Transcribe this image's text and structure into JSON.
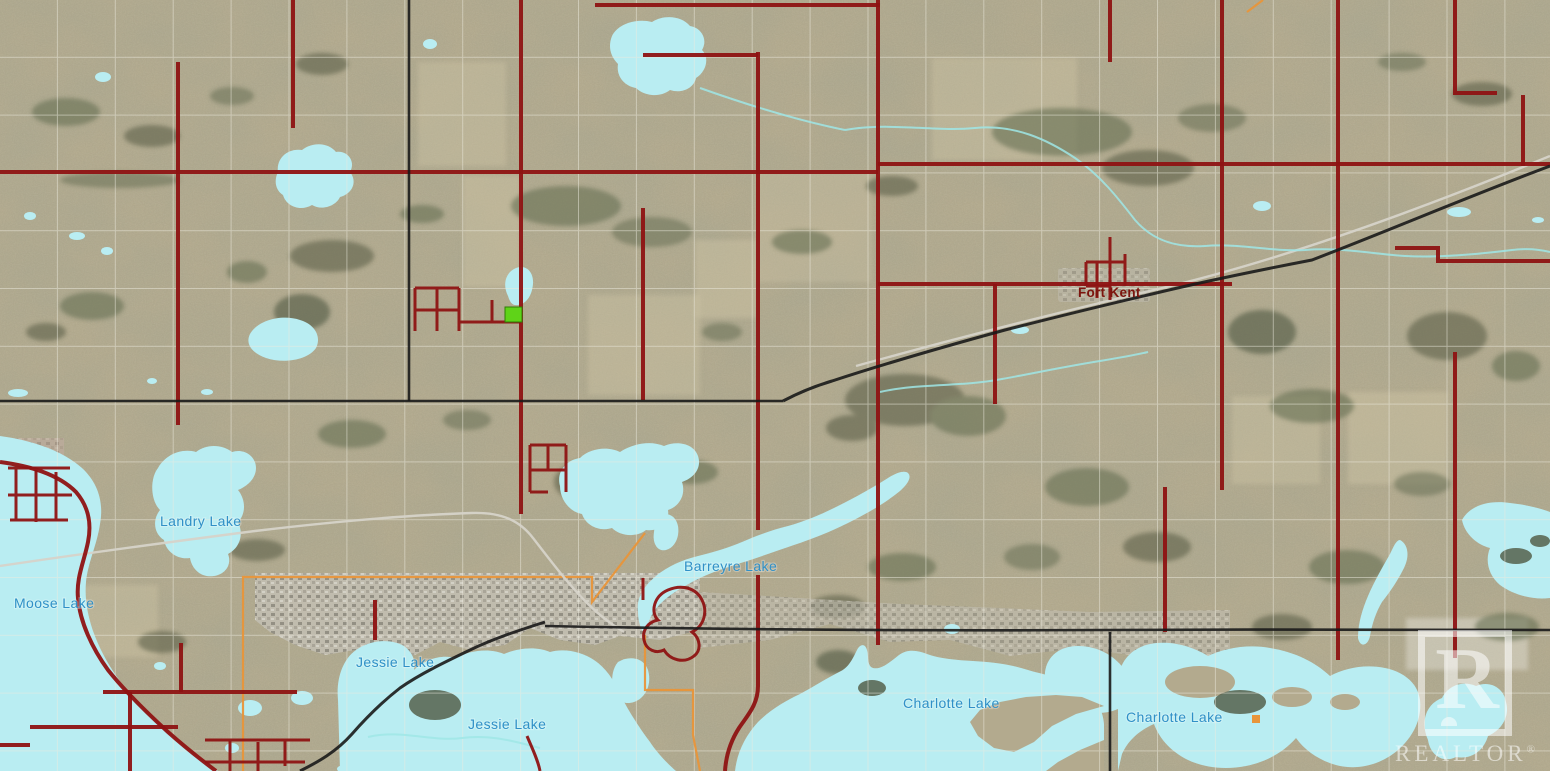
{
  "map": {
    "labels": {
      "lakes": [
        {
          "name": "moose-lake",
          "text": "Moose Lake"
        },
        {
          "name": "landry-lake",
          "text": "Landry Lake"
        },
        {
          "name": "barreyre-lake",
          "text": "Barreyre Lake"
        },
        {
          "name": "jessie-lake-west",
          "text": "Jessie Lake"
        },
        {
          "name": "jessie-lake-main",
          "text": "Jessie Lake"
        },
        {
          "name": "charlotte-lake-west",
          "text": "Charlotte Lake"
        },
        {
          "name": "charlotte-lake-east",
          "text": "Charlotte Lake"
        }
      ],
      "places": [
        {
          "name": "fort-kent",
          "text": "Fort Kent"
        }
      ]
    }
  },
  "watermark": {
    "logo_letter": "R",
    "brand": "REALTOR",
    "registered_mark": "®"
  },
  "colors": {
    "land-base": "#b3aa8e",
    "lake": "#b9edf2",
    "road-red": "#8e1313",
    "road-black": "#1a1a1a",
    "road-gray": "#d6d3c9",
    "grid": "#eceade",
    "boundary-orange": "#e8953a",
    "label-blue": "#3090c7",
    "label-maroon": "#7c150e",
    "parcel-green": "#5fd318",
    "watermark-white": "#ffffff"
  }
}
